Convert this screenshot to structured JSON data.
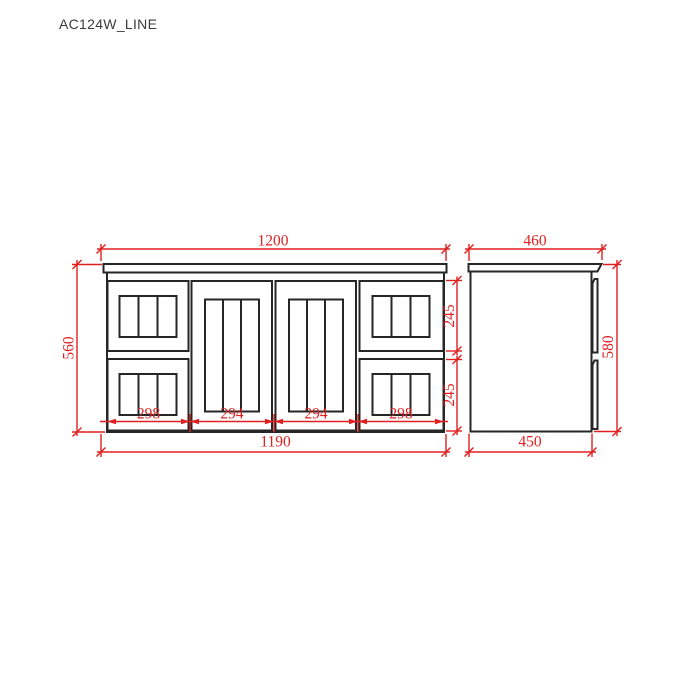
{
  "title": "AC124W_LINE",
  "colors": {
    "line": "#262626",
    "dimension": "#e02020",
    "background": "#ffffff"
  },
  "front_view": {
    "label": "vanity front elevation",
    "dims": {
      "top_width": "1200",
      "left_height": "560",
      "right_top_drawer_height": "245",
      "right_bottom_drawer_height": "245",
      "segments": [
        "298",
        "294",
        "294",
        "298"
      ],
      "bottom_width": "1190"
    }
  },
  "side_view": {
    "label": "vanity side elevation",
    "dims": {
      "top_width": "460",
      "right_height": "580",
      "bottom_width": "450"
    }
  }
}
